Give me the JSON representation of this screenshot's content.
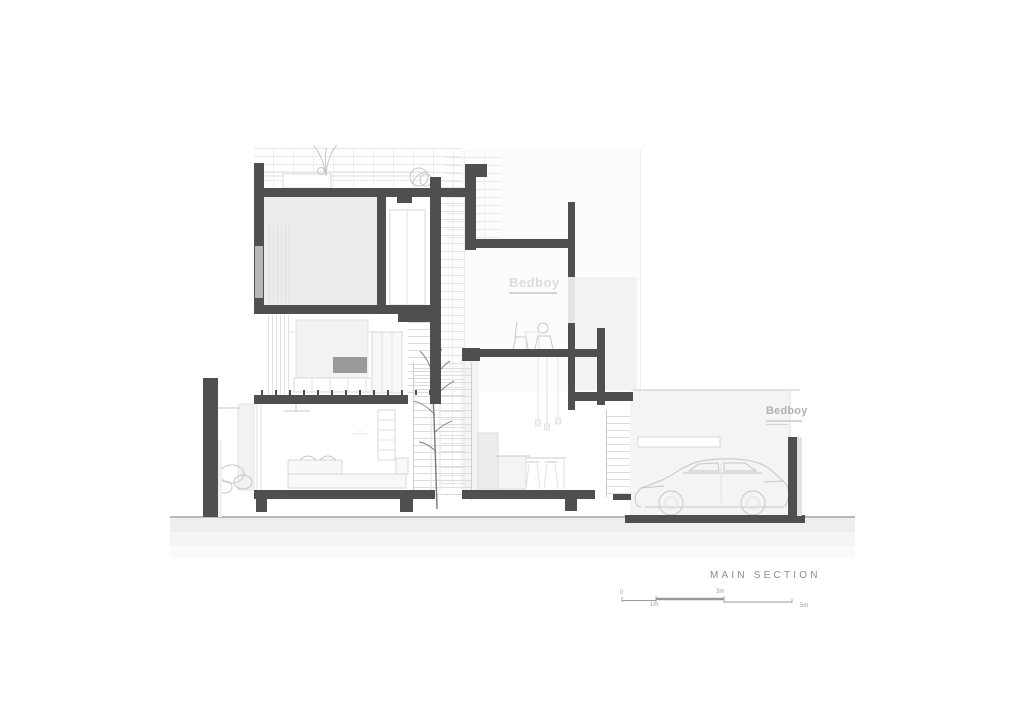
{
  "drawing": {
    "title": "MAIN SECTION",
    "branding": {
      "room_logo": "Bedboy",
      "garage_logo": "Bedboy"
    },
    "scale_bar": {
      "labels": [
        "0",
        "1m",
        "3m",
        "5m"
      ]
    },
    "colors": {
      "paper": "#ffffff",
      "cut_dark": "#4f4f4f",
      "cut_medium": "#b8b8b8",
      "glass_cut": "#e4e4e4",
      "room_fill": "#ececec",
      "panel_fill": "#f3f3f3",
      "garage_wall": "#f4f4f4",
      "tv_fill": "#9a9a9a",
      "line_medium": "#c9c9c9",
      "line_light": "#e2e2e2",
      "sketch": "#c6c6c6",
      "tree": "#7a7a7a",
      "ground_line": "#8f8f8f",
      "title_text": "#8c8c8c",
      "logo_light": "#dcdcdc",
      "logo_gray": "#b2b2b2",
      "scale_text": "#a0a0a0"
    }
  }
}
